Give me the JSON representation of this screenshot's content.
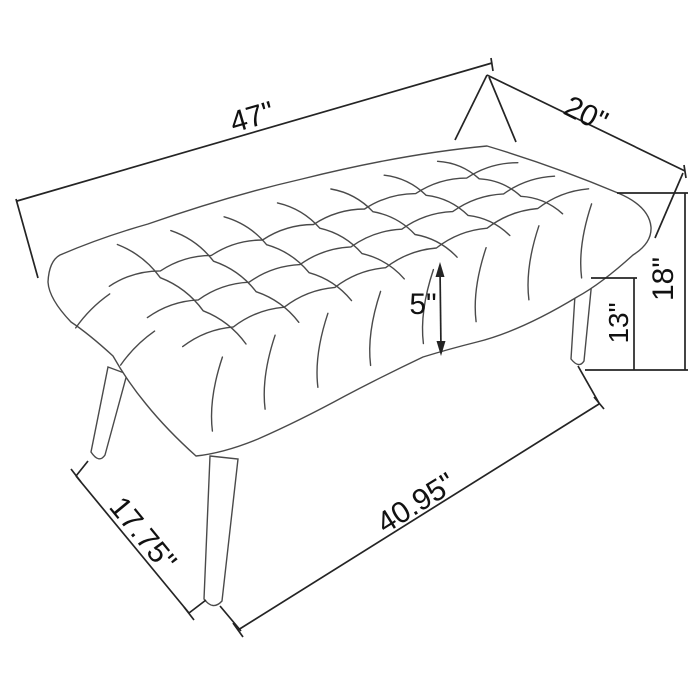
{
  "figure": {
    "type": "furniture-dimension-diagram",
    "subject": "Diamond-tufted upholstered bench with splayed tapered legs, isometric line drawing",
    "unit": "inches",
    "colors": {
      "background": "#ffffff",
      "bench_line": "#4a4a4a",
      "dimension_line": "#242424",
      "text": "#111111"
    },
    "dimensions": {
      "seat_length_top": "47\"",
      "seat_depth_top": "20\"",
      "cushion_thickness": "5\"",
      "floor_to_seat_bottom": "13\"",
      "overall_height": "18\"",
      "leg_footprint_depth": "17.75\"",
      "leg_footprint_length": "40.95\""
    }
  }
}
